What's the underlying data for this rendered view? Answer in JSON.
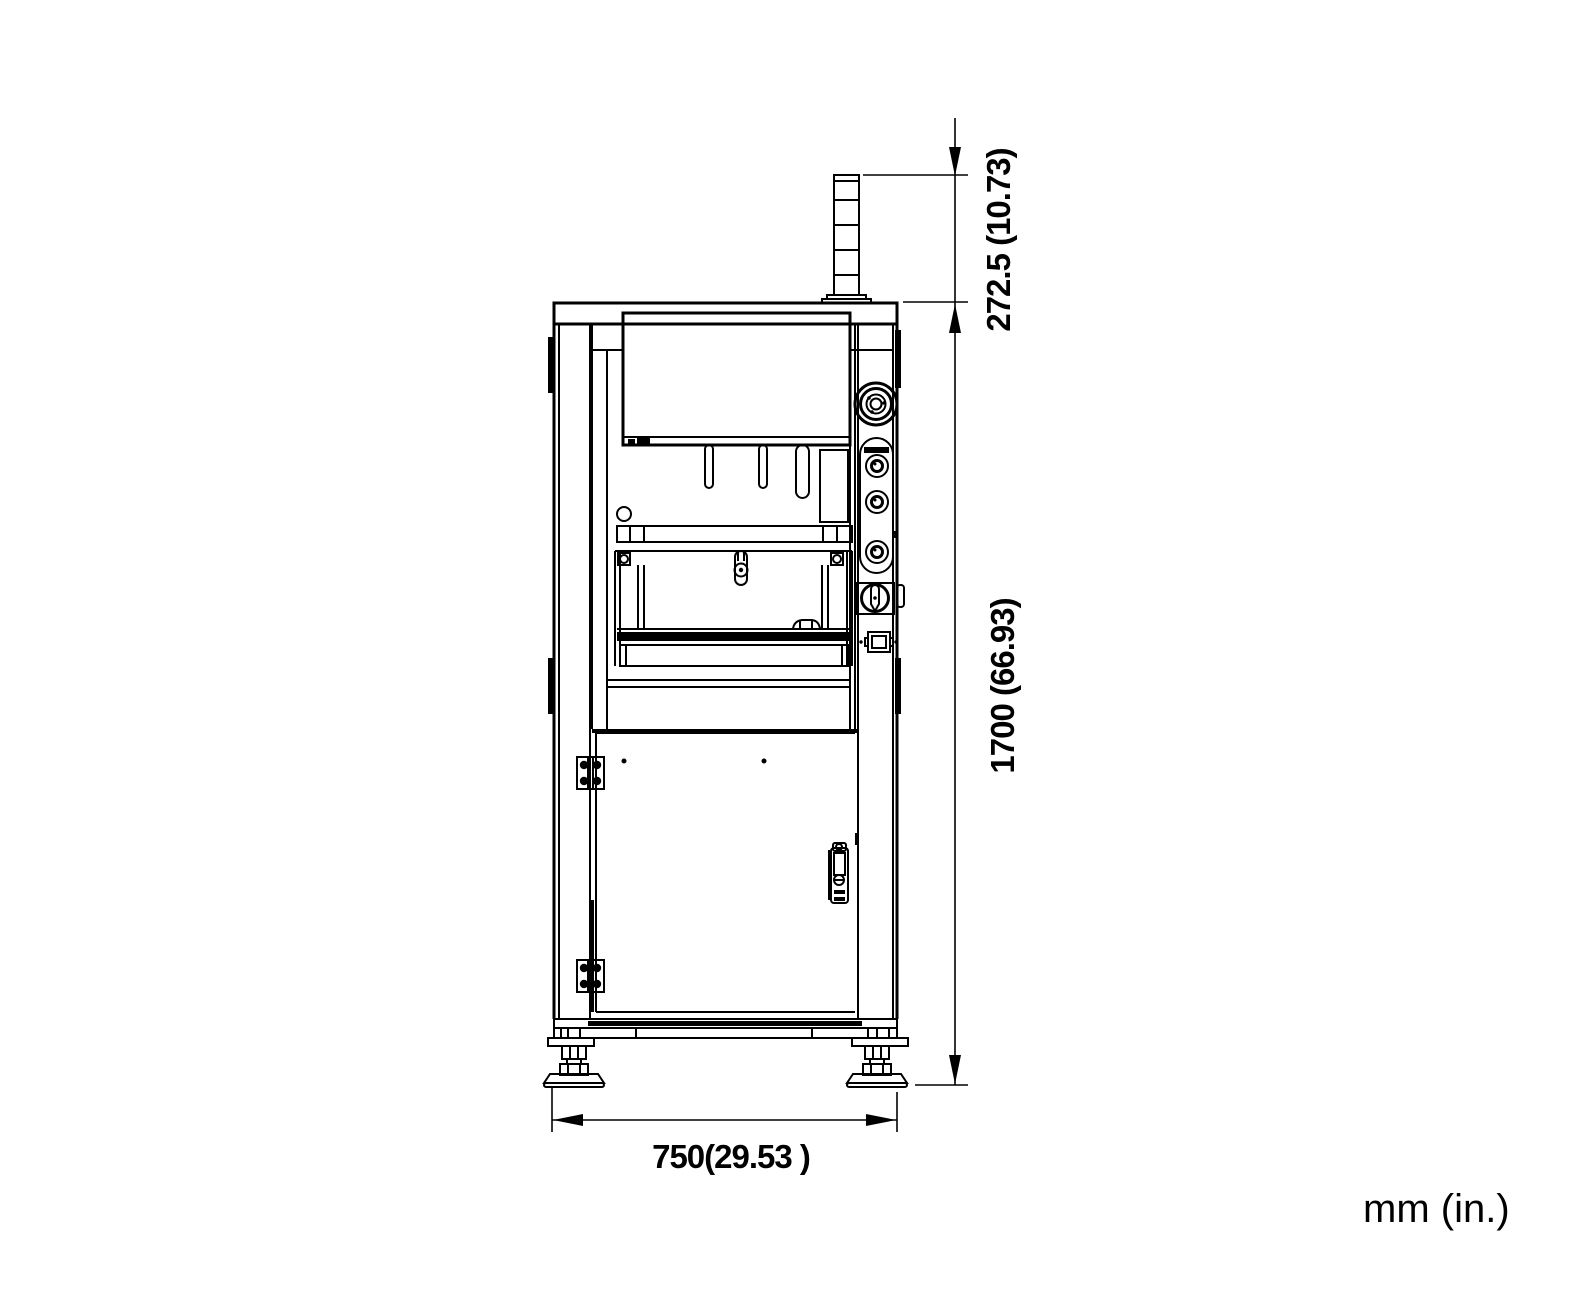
{
  "drawing": {
    "dimensions": {
      "tower_height": "272.5 (10.73)",
      "overall_height": "1700 (66.93)",
      "overall_width": "750(29.53 )"
    },
    "units_label": "mm (in.)"
  }
}
